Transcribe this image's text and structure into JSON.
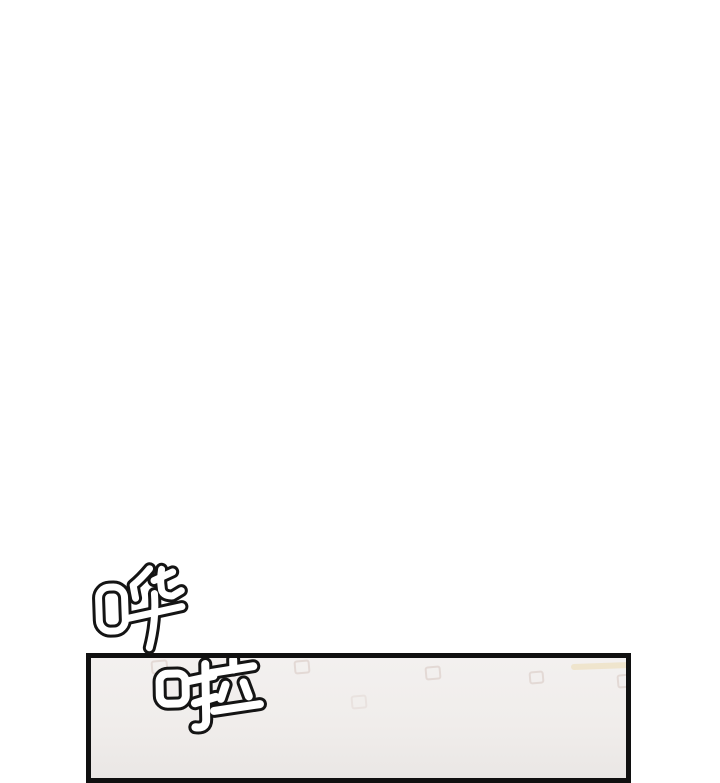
{
  "page": {
    "background_color": "#ffffff"
  },
  "sfx": {
    "hua": "哗",
    "la": "啦"
  },
  "panel": {
    "border_color": "#101010",
    "background_color": "#f1eeec",
    "pattern_square_color": "#e3d9d5"
  }
}
